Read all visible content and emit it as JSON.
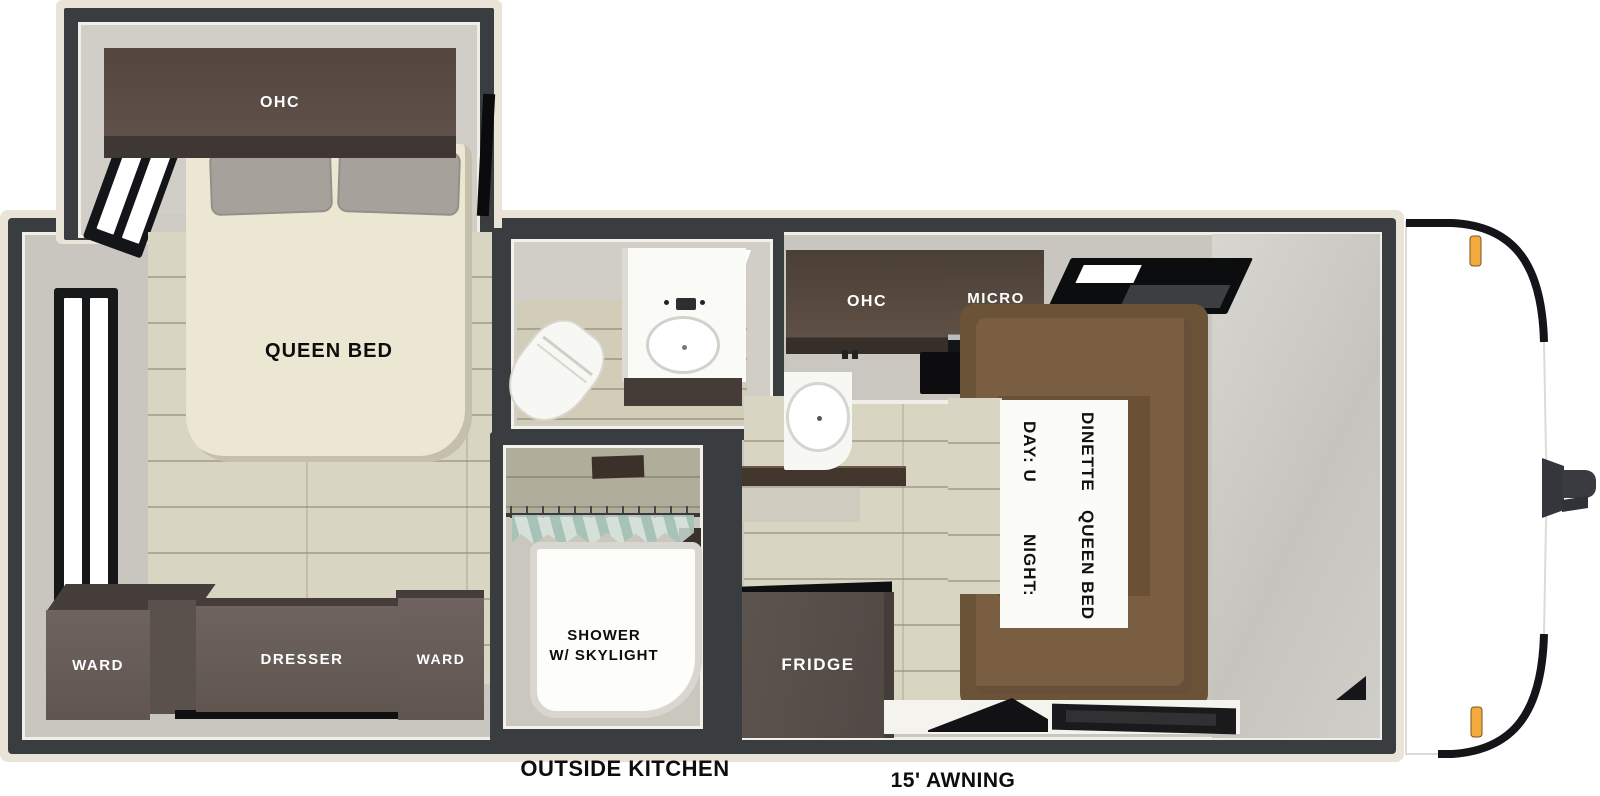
{
  "title": "Travel trailer floor plan",
  "colors": {
    "wall": "#3a3d40",
    "outer_trim": "#e9e4d7",
    "floor_wood": "#d9d5c3",
    "cabinet_dark": "#6e635f",
    "kitchen_cabinet": "#5d4e43",
    "dinette_brown": "#6b5338",
    "marker_light_amber": "#f3ab3e"
  },
  "bedroom": {
    "ohc_label": "OHC",
    "bed_label": "QUEEN BED",
    "ward_left_label": "WARD",
    "dresser_label": "DRESSER",
    "ward_right_label": "WARD"
  },
  "shower": {
    "line1": "SHOWER",
    "line2": "W/ SKYLIGHT"
  },
  "kitchen": {
    "ohc_label": "OHC",
    "micro_label": "MICRO",
    "fridge_label": "FRIDGE"
  },
  "dinette": {
    "line1": "DAY: U DINETTE",
    "line2": "NIGHT: QUEEN BED"
  },
  "exterior": {
    "outside_kitchen_label": "OUTSIDE KITCHEN",
    "awning_label": "15' AWNING"
  }
}
